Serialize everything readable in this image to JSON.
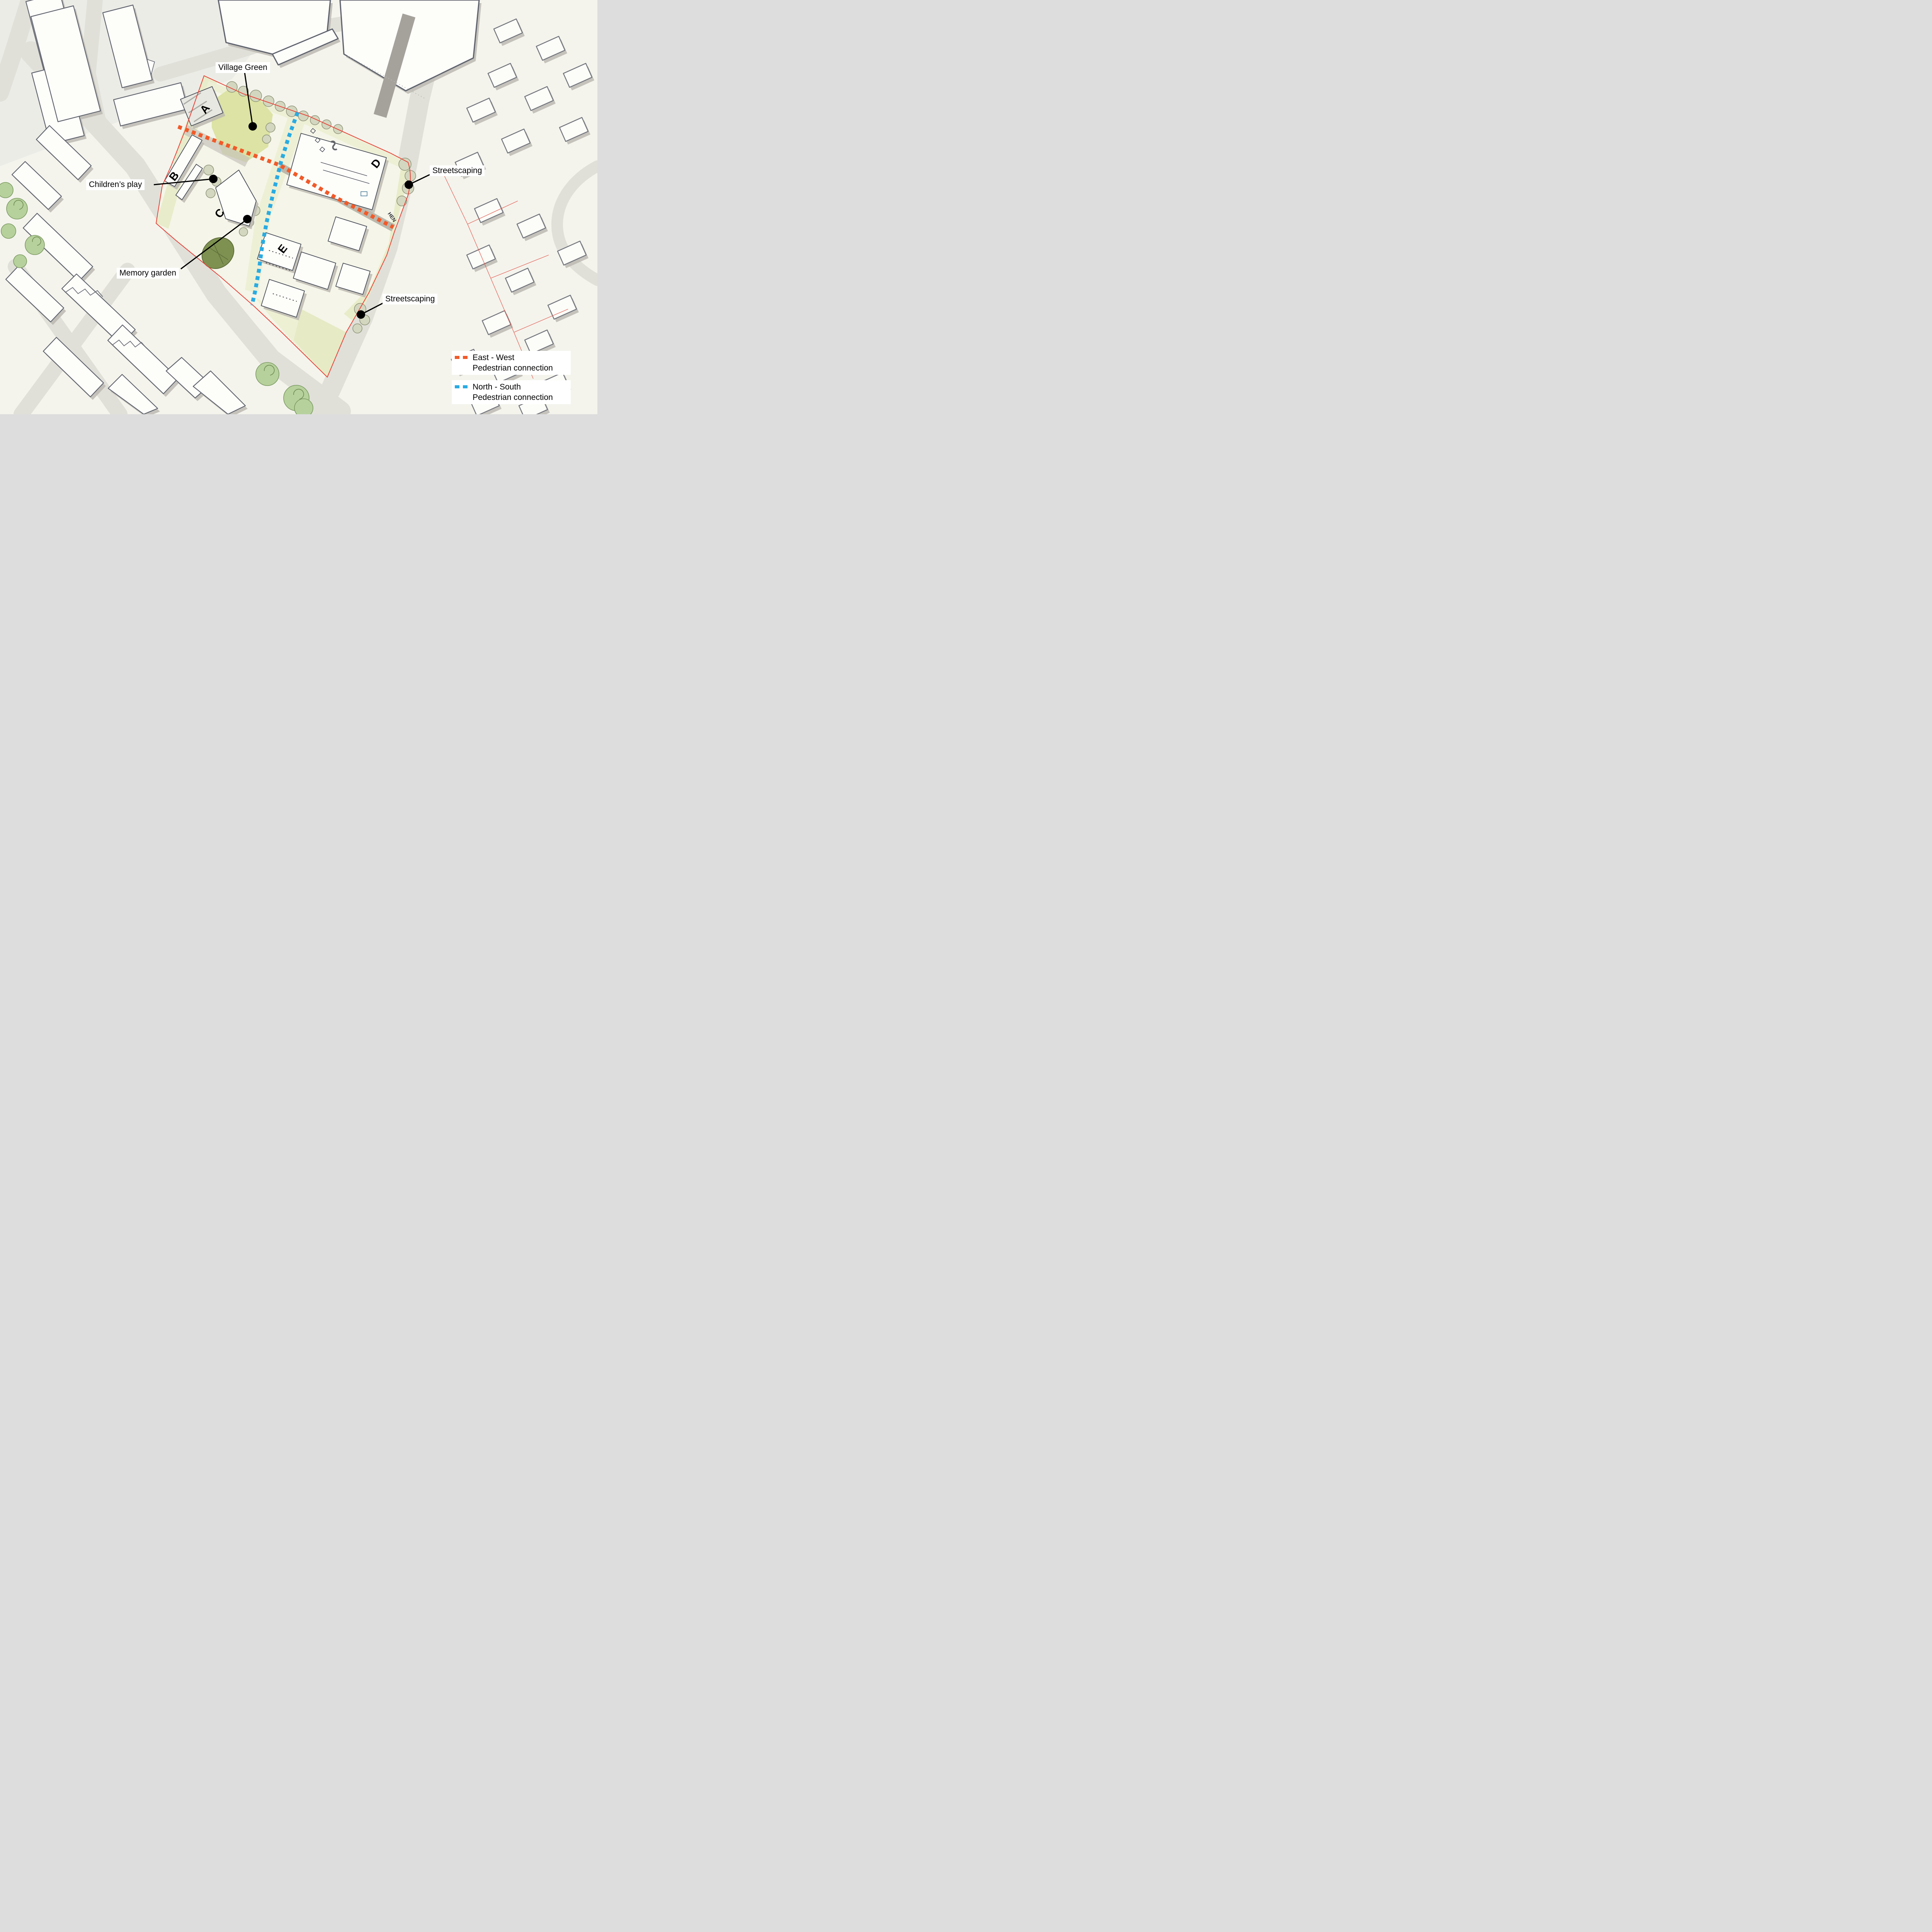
{
  "annotations": {
    "village_green": {
      "label": "Village Green"
    },
    "childrens_play": {
      "label": "Children’s play"
    },
    "memory_garden": {
      "label": "Memory garden"
    },
    "streetscaping_north": {
      "label": "Streetscaping"
    },
    "streetscaping_south": {
      "label": "Streetscaping"
    }
  },
  "blocks": {
    "a": "A",
    "b": "B",
    "c": "C",
    "d": "D",
    "e": "E"
  },
  "street_label": "HEN",
  "legend": {
    "items": [
      {
        "id": "east-west",
        "color": "#F15A29",
        "line1": "East - West",
        "line2": "Pedestrian connection"
      },
      {
        "id": "north-south",
        "color": "#29ABE2",
        "line1": "North - South",
        "line2": "Pedestrian connection"
      }
    ]
  },
  "colors": {
    "east_west_orange": "#F15A29",
    "north_south_blue": "#29ABE2",
    "site_boundary_red": "#E8453C",
    "annotation_black": "#000000"
  }
}
